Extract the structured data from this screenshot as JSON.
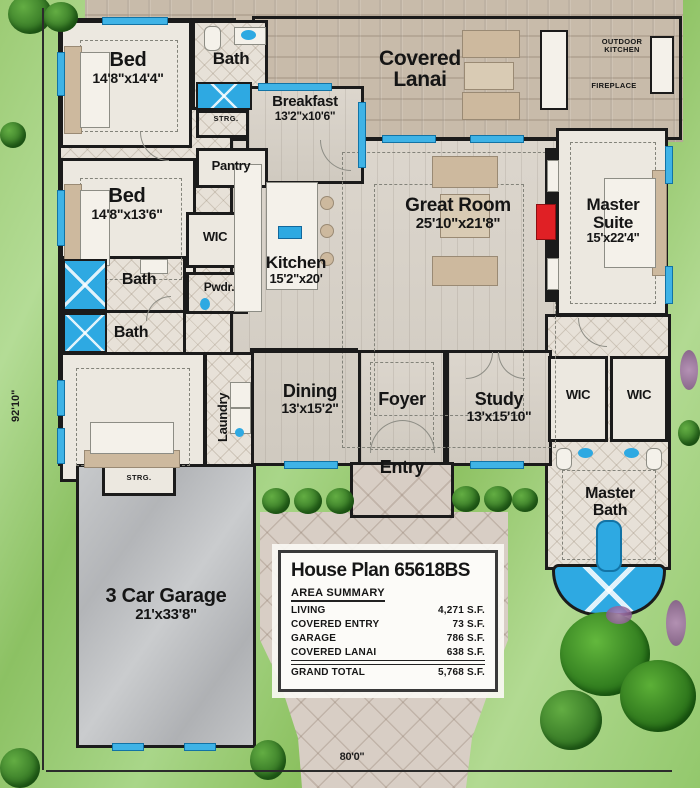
{
  "plan": {
    "title": "House Plan 65618BS",
    "overall_width": "80'0\"",
    "overall_height": "92'10\""
  },
  "rooms": {
    "bed1": {
      "name": "Bed",
      "dims": "14'8\"x14'4\""
    },
    "bed2": {
      "name": "Bed",
      "dims": "14'8\"x13'6\""
    },
    "bed3": {
      "name": "Bed",
      "dims": "13'6\"x14'8\""
    },
    "bath": {
      "name": "Bath"
    },
    "breakfast": {
      "name": "Breakfast",
      "dims": "13'2\"x10'6\""
    },
    "lanai": {
      "name": "Covered Lanai"
    },
    "great": {
      "name": "Great Room",
      "dims": "25'10\"x21'8\""
    },
    "master": {
      "name": "Master Suite",
      "dims": "15'x22'4\""
    },
    "kitchen": {
      "name": "Kitchen",
      "dims": "15'2\"x20'"
    },
    "dining": {
      "name": "Dining",
      "dims": "13'x15'2\""
    },
    "study": {
      "name": "Study",
      "dims": "13'x15'10\""
    },
    "foyer": {
      "name": "Foyer"
    },
    "entry": {
      "name": "Entry"
    },
    "master_bath": {
      "name": "Master Bath"
    },
    "garage": {
      "name": "3 Car Garage",
      "dims": "21'x33'8\""
    },
    "laundry": {
      "name": "Laundry"
    },
    "pantry": {
      "name": "Pantry"
    },
    "wic": {
      "name": "WIC"
    },
    "pwdr": {
      "name": "Pwdr."
    }
  },
  "labels": {
    "strg": "STRG.",
    "fireplace": "FIREPLACE",
    "outdoor_kitchen": "OUTDOOR KITCHEN"
  },
  "info_box": {
    "title": "House Plan 65618BS",
    "summary_title": "AREA SUMMARY",
    "rows": [
      {
        "label": "LIVING",
        "value": "4,271 S.F."
      },
      {
        "label": "COVERED ENTRY",
        "value": "73 S.F."
      },
      {
        "label": "GARAGE",
        "value": "786 S.F."
      },
      {
        "label": "COVERED LANAI",
        "value": "638 S.F."
      },
      {
        "label": "GRAND TOTAL",
        "value": "5,768 S.F."
      }
    ]
  },
  "colors": {
    "grass": "#94ca6d",
    "tile": "#c8bbaa",
    "wall": "#1b1b1b",
    "window_blue": "#3fb3e6",
    "water_blue": "#2ea9e2",
    "accent_red": "#e02025",
    "garage_gray": "#bcbec0",
    "drive": "#d8cec5"
  }
}
